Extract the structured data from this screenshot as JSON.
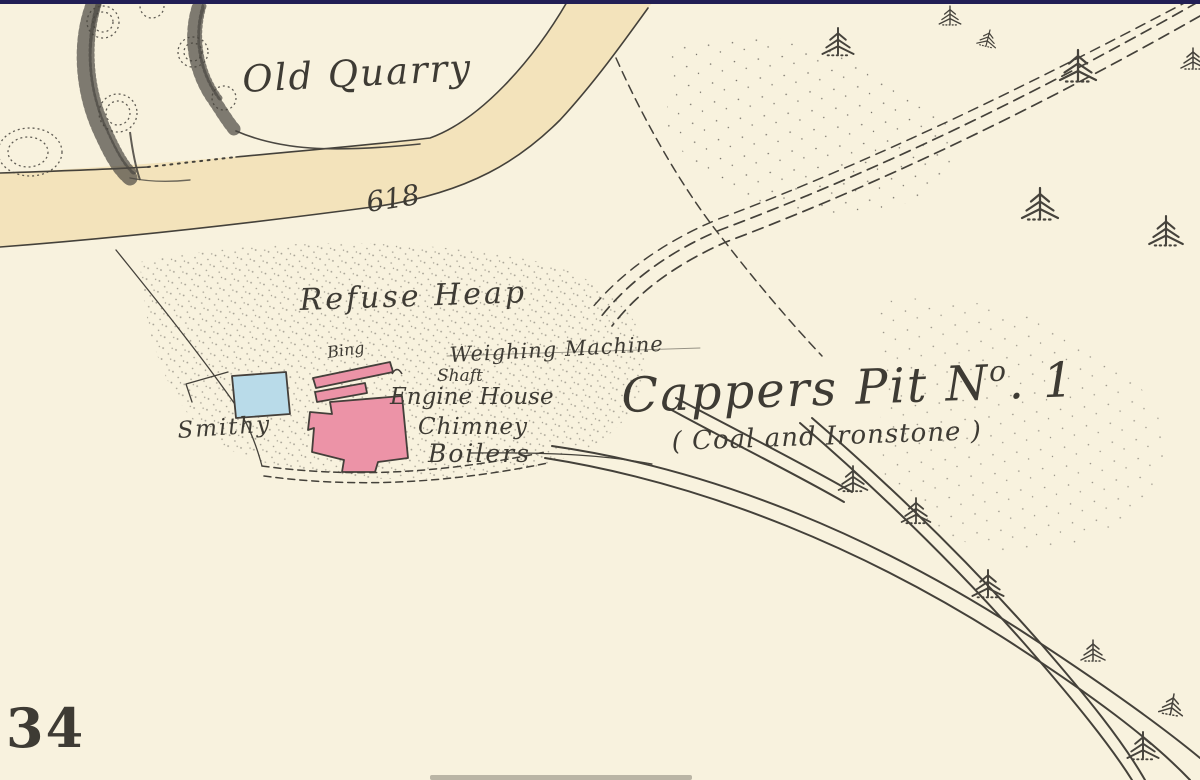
{
  "map": {
    "description": "Historical Ordnance Survey style colliery map extract",
    "labels": {
      "old_quarry": "Old Quarry",
      "spot_number": "618",
      "refuse_heap": "Refuse Heap",
      "bing": "Bing",
      "weighing_machine": "Weighing Machine",
      "shaft": "Shaft",
      "engine_house": "Engine House",
      "chimney": "Chimney",
      "boilers": "Boilers",
      "smithy": "Smithy",
      "pit_name": "Cappers Pit N",
      "pit_no_superscript": "o",
      "pit_no_rest": ". 1",
      "pit_subtitle": "( Coal and Ironstone )",
      "sheet_number": "34"
    },
    "colors": {
      "paper": "#f8f2de",
      "road_fill": "#f3e3bb",
      "ink": "#44413a",
      "building_pink": "#ec93a7",
      "building_blue": "#b9dbe9",
      "top_border_navy": "#221f55"
    },
    "features": {
      "road": "unnamed road running from west to north",
      "quarry": "Old Quarry with hachured faces and trees",
      "refuse_heap_area": "stippled refuse heap ground",
      "colliery": "Cappers Pit No.1 building cluster",
      "railways": "mineral railway lines to south-east with fir trees",
      "tracks": "dashed cart tracks and boundaries"
    }
  }
}
